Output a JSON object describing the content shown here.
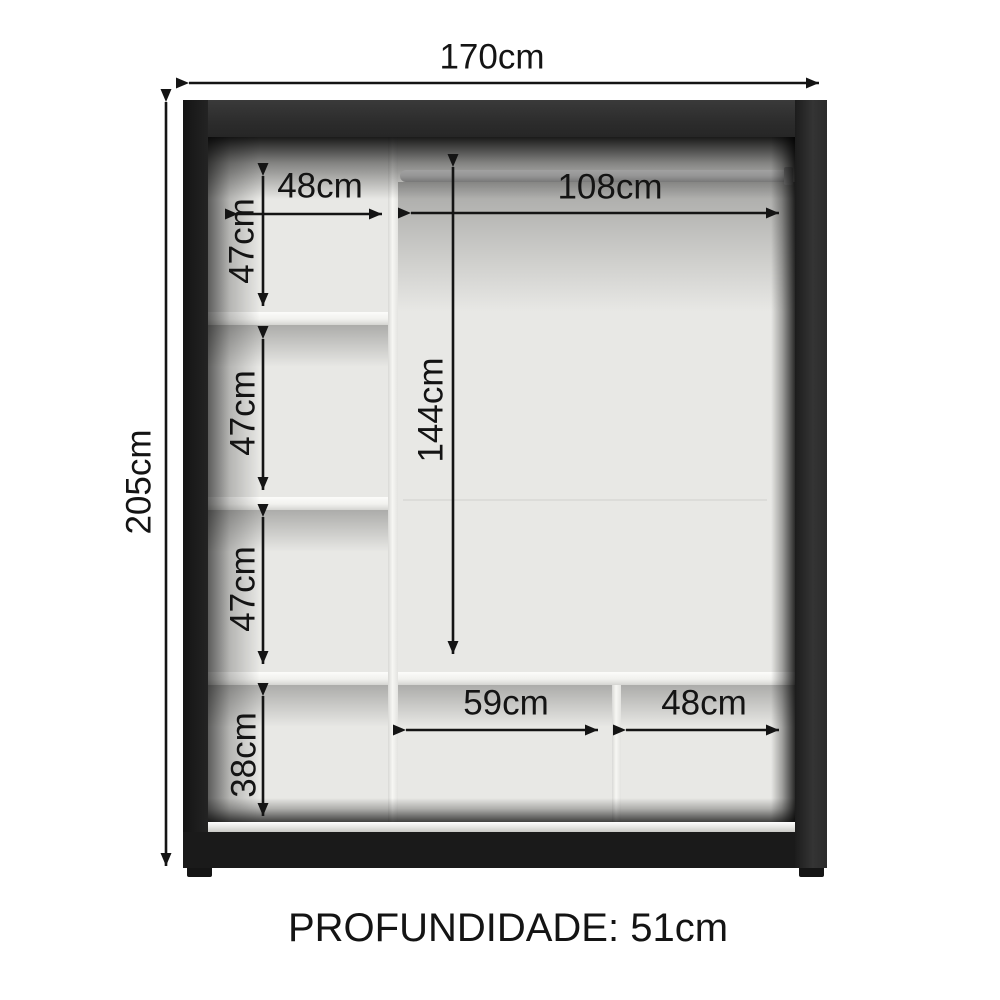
{
  "diagram": {
    "labels": {
      "total_width": "170cm",
      "total_height": "205cm",
      "top_shelf_width": "48cm",
      "hanging_width": "108cm",
      "shelf_gap_1": "47cm",
      "shelf_gap_2": "47cm",
      "shelf_gap_3": "47cm",
      "hanging_height": "144cm",
      "bottom_gap_height": "38cm",
      "bottom_middle_width": "59cm",
      "bottom_right_width": "48cm",
      "depth": "PROFUNDIDADE: 51cm"
    },
    "colors": {
      "frame": "#242424",
      "interior_panel": "#e8e8e5",
      "shelf": "#f1f1ee",
      "annotation_text": "#141414",
      "background": "#ffffff"
    }
  }
}
